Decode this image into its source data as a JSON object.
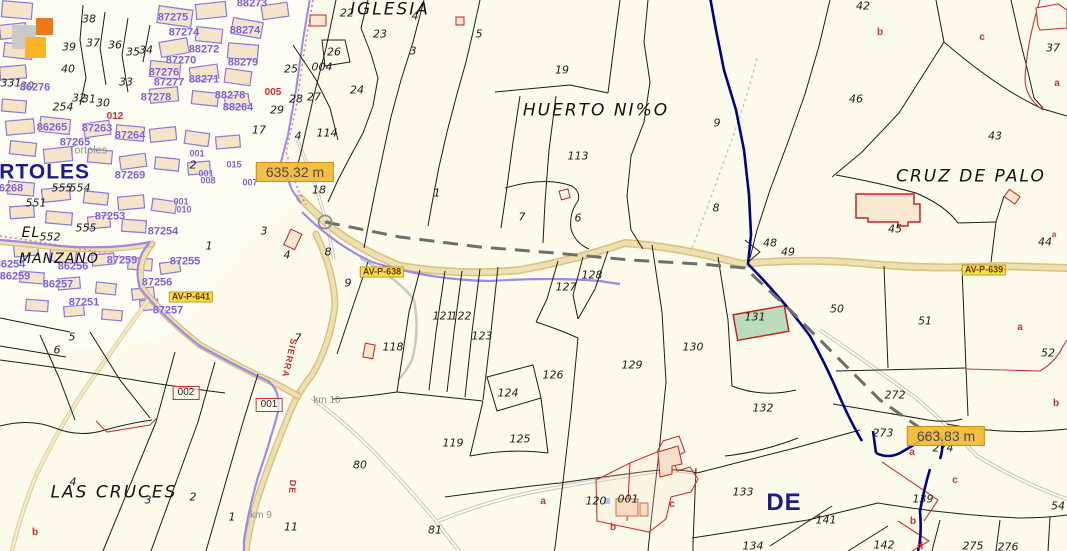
{
  "place_labels": {
    "iglesia": "IGLESIA",
    "huerto": "HUERTO NI%O",
    "cruz_de_palo": "CRUZ DE PALO",
    "el": "EL",
    "manzano": "MANZANO",
    "las_cruces": "LAS CRUCES",
    "town_gray": "Tortoles",
    "town_navy": "ORTOLES",
    "de_navy": "DE"
  },
  "streets": {
    "sierra": "SIERRA",
    "de": "DE"
  },
  "roads": {
    "av638": "AV-P-638",
    "av641": "AV-P-641",
    "av639": "AV-P-639"
  },
  "measurements": {
    "first": "635.32 m",
    "second": "663.83 m"
  },
  "km": {
    "km10": "km 10",
    "km9": "km 9"
  },
  "boxed": {
    "b002": "002",
    "b001": "001"
  },
  "colors": {
    "background": "#FDFCEC",
    "parcel_line": "#1C1C1C",
    "urban_purple": "#8878DD",
    "block_label": "#7B5FD9",
    "boundary_navy": "#00008B",
    "road_fill": "#EFE0B0",
    "road_edge": "#D8C080",
    "road_purple": "#9B8AE8",
    "measure_dash": "#6E6E6E",
    "measure_box": "#F3BA34",
    "road_label_box": "#F2E14C",
    "subparcel_red": "#D03030",
    "building_green": "#BBDDBB",
    "tile_gray": "#C9C9C9",
    "tile_orange": "#F07818",
    "tile_amber": "#FFB428"
  },
  "parcel_numbers": [
    {
      "t": "38",
      "x": 89,
      "y": 19
    },
    {
      "t": "39",
      "x": 69,
      "y": 47
    },
    {
      "t": "37",
      "x": 93,
      "y": 43
    },
    {
      "t": "36",
      "x": 115,
      "y": 45
    },
    {
      "t": "35",
      "x": 133,
      "y": 52
    },
    {
      "t": "34",
      "x": 146,
      "y": 50
    },
    {
      "t": "40",
      "x": 68,
      "y": 69
    },
    {
      "t": "33",
      "x": 126,
      "y": 82
    },
    {
      "t": "32",
      "x": 79,
      "y": 98
    },
    {
      "t": "31",
      "x": 89,
      "y": 99
    },
    {
      "t": "30",
      "x": 103,
      "y": 103
    },
    {
      "t": "254",
      "x": 63,
      "y": 107
    },
    {
      "t": "331",
      "x": 11,
      "y": 83
    },
    {
      "t": "30",
      "x": 27,
      "y": 86
    },
    {
      "t": "25",
      "x": 291,
      "y": 69
    },
    {
      "t": "28",
      "x": 296,
      "y": 99
    },
    {
      "t": "29",
      "x": 277,
      "y": 110
    },
    {
      "t": "27",
      "x": 314,
      "y": 97
    },
    {
      "t": "26",
      "x": 334,
      "y": 52
    },
    {
      "t": "004",
      "x": 322,
      "y": 67
    },
    {
      "t": "24",
      "x": 357,
      "y": 90
    },
    {
      "t": "23",
      "x": 380,
      "y": 34
    },
    {
      "t": "22",
      "x": 347,
      "y": 13
    },
    {
      "t": "114",
      "x": 327,
      "y": 133
    },
    {
      "t": "17",
      "x": 259,
      "y": 130
    },
    {
      "t": "4",
      "x": 298,
      "y": 136
    },
    {
      "t": "4",
      "x": 415,
      "y": 16
    },
    {
      "t": "3",
      "x": 413,
      "y": 51
    },
    {
      "t": "5",
      "x": 479,
      "y": 34
    },
    {
      "t": "2",
      "x": 193,
      "y": 165
    },
    {
      "t": "18",
      "x": 319,
      "y": 190
    },
    {
      "t": "1",
      "x": 209,
      "y": 246
    },
    {
      "t": "3",
      "x": 264,
      "y": 231
    },
    {
      "t": "4",
      "x": 287,
      "y": 255
    },
    {
      "t": "8",
      "x": 328,
      "y": 252
    },
    {
      "t": "19",
      "x": 562,
      "y": 70
    },
    {
      "t": "113",
      "x": 578,
      "y": 156
    },
    {
      "t": "9",
      "x": 717,
      "y": 123
    },
    {
      "t": "1",
      "x": 437,
      "y": 193
    },
    {
      "t": "7",
      "x": 522,
      "y": 217
    },
    {
      "t": "6",
      "x": 578,
      "y": 218
    },
    {
      "t": "8",
      "x": 716,
      "y": 208
    },
    {
      "t": "555",
      "x": 62,
      "y": 188
    },
    {
      "t": "554",
      "x": 80,
      "y": 188
    },
    {
      "t": "551",
      "x": 36,
      "y": 203
    },
    {
      "t": "555",
      "x": 86,
      "y": 228
    },
    {
      "t": "552",
      "x": 50,
      "y": 237
    },
    {
      "t": "48",
      "x": 770,
      "y": 243
    },
    {
      "t": "49",
      "x": 788,
      "y": 252
    },
    {
      "t": "42",
      "x": 863,
      "y": 6
    },
    {
      "t": "46",
      "x": 856,
      "y": 99
    },
    {
      "t": "37",
      "x": 1053,
      "y": 48
    },
    {
      "t": "43",
      "x": 995,
      "y": 136
    },
    {
      "t": "45",
      "x": 895,
      "y": 229
    },
    {
      "t": "44",
      "x": 1045,
      "y": 242
    },
    {
      "t": "50",
      "x": 837,
      "y": 309
    },
    {
      "t": "51",
      "x": 925,
      "y": 321
    },
    {
      "t": "52",
      "x": 1048,
      "y": 353
    },
    {
      "t": "272",
      "x": 895,
      "y": 395
    },
    {
      "t": "273",
      "x": 883,
      "y": 433
    },
    {
      "t": "274",
      "x": 943,
      "y": 448
    },
    {
      "t": "9",
      "x": 348,
      "y": 283
    },
    {
      "t": "7",
      "x": 298,
      "y": 338
    },
    {
      "t": "5",
      "x": 72,
      "y": 337
    },
    {
      "t": "6",
      "x": 57,
      "y": 350
    },
    {
      "t": "118",
      "x": 393,
      "y": 347
    },
    {
      "t": "121",
      "x": 443,
      "y": 316
    },
    {
      "t": "122",
      "x": 461,
      "y": 316
    },
    {
      "t": "123",
      "x": 482,
      "y": 336
    },
    {
      "t": "124",
      "x": 508,
      "y": 393
    },
    {
      "t": "125",
      "x": 520,
      "y": 439
    },
    {
      "t": "119",
      "x": 453,
      "y": 443
    },
    {
      "t": "126",
      "x": 553,
      "y": 375
    },
    {
      "t": "127",
      "x": 566,
      "y": 287
    },
    {
      "t": "128",
      "x": 592,
      "y": 275
    },
    {
      "t": "129",
      "x": 632,
      "y": 365
    },
    {
      "t": "130",
      "x": 693,
      "y": 347
    },
    {
      "t": "131",
      "x": 755,
      "y": 317
    },
    {
      "t": "132",
      "x": 763,
      "y": 408
    },
    {
      "t": "80",
      "x": 360,
      "y": 465
    },
    {
      "t": "81",
      "x": 435,
      "y": 530
    },
    {
      "t": "11",
      "x": 291,
      "y": 527
    },
    {
      "t": "120",
      "x": 596,
      "y": 501
    },
    {
      "t": "001",
      "x": 628,
      "y": 499
    },
    {
      "t": "133",
      "x": 743,
      "y": 492
    },
    {
      "t": "134",
      "x": 753,
      "y": 546
    },
    {
      "t": "141",
      "x": 826,
      "y": 520
    },
    {
      "t": "142",
      "x": 884,
      "y": 545
    },
    {
      "t": "139",
      "x": 923,
      "y": 499
    },
    {
      "t": "54",
      "x": 1058,
      "y": 506
    },
    {
      "t": "275",
      "x": 973,
      "y": 546
    },
    {
      "t": "276",
      "x": 1008,
      "y": 547
    },
    {
      "t": "4",
      "x": 73,
      "y": 482
    },
    {
      "t": "3",
      "x": 148,
      "y": 500
    },
    {
      "t": "2",
      "x": 193,
      "y": 497
    },
    {
      "t": "1",
      "x": 232,
      "y": 517
    }
  ],
  "block_labels": [
    {
      "t": "87275",
      "x": 173,
      "y": 18
    },
    {
      "t": "87274",
      "x": 184,
      "y": 33
    },
    {
      "t": "88274",
      "x": 245,
      "y": 31
    },
    {
      "t": "88273",
      "x": 252,
      "y": 4
    },
    {
      "t": "88272",
      "x": 204,
      "y": 50
    },
    {
      "t": "87270",
      "x": 181,
      "y": 61
    },
    {
      "t": "88279",
      "x": 243,
      "y": 63
    },
    {
      "t": "87276",
      "x": 164,
      "y": 73
    },
    {
      "t": "87277",
      "x": 169,
      "y": 83
    },
    {
      "t": "88271",
      "x": 204,
      "y": 80
    },
    {
      "t": "87278",
      "x": 156,
      "y": 98
    },
    {
      "t": "88278",
      "x": 230,
      "y": 96
    },
    {
      "t": "88264",
      "x": 238,
      "y": 108
    },
    {
      "t": "86276",
      "x": 35,
      "y": 88
    },
    {
      "t": "86265",
      "x": 52,
      "y": 128
    },
    {
      "t": "87263",
      "x": 97,
      "y": 129
    },
    {
      "t": "87264",
      "x": 130,
      "y": 136
    },
    {
      "t": "87265",
      "x": 75,
      "y": 143
    },
    {
      "t": "87269",
      "x": 130,
      "y": 176
    },
    {
      "t": "86268",
      "x": 8,
      "y": 189
    },
    {
      "t": "87253",
      "x": 110,
      "y": 217
    },
    {
      "t": "87254",
      "x": 163,
      "y": 232
    },
    {
      "t": "87259",
      "x": 122,
      "y": 261
    },
    {
      "t": "87255",
      "x": 185,
      "y": 262
    },
    {
      "t": "86256",
      "x": 73,
      "y": 267
    },
    {
      "t": "86254",
      "x": 10,
      "y": 265
    },
    {
      "t": "86259",
      "x": 15,
      "y": 277
    },
    {
      "t": "86257",
      "x": 58,
      "y": 285
    },
    {
      "t": "87256",
      "x": 157,
      "y": 283
    },
    {
      "t": "87251",
      "x": 84,
      "y": 303
    },
    {
      "t": "87257",
      "x": 168,
      "y": 311
    }
  ],
  "urban_small_labels": [
    {
      "t": "001",
      "x": 197,
      "y": 154
    },
    {
      "t": "015",
      "x": 234,
      "y": 165
    },
    {
      "t": "001",
      "x": 206,
      "y": 174
    },
    {
      "t": "008",
      "x": 208,
      "y": 181
    },
    {
      "t": "007",
      "x": 250,
      "y": 183
    },
    {
      "t": "001",
      "x": 181,
      "y": 202
    },
    {
      "t": "010",
      "x": 184,
      "y": 210
    }
  ],
  "red_letters": [
    {
      "t": "b",
      "x": 880,
      "y": 33
    },
    {
      "t": "c",
      "x": 982,
      "y": 38
    },
    {
      "t": "a",
      "x": 1057,
      "y": 84
    },
    {
      "t": "a",
      "x": 1054,
      "y": 235,
      "s": 8
    },
    {
      "t": "a",
      "x": 1020,
      "y": 328
    },
    {
      "t": "b",
      "x": 1056,
      "y": 404
    },
    {
      "t": "a",
      "x": 912,
      "y": 453
    },
    {
      "t": "c",
      "x": 955,
      "y": 481
    },
    {
      "t": "b",
      "x": 913,
      "y": 522
    },
    {
      "t": "d",
      "x": 920,
      "y": 547
    },
    {
      "t": "a",
      "x": 543,
      "y": 502
    },
    {
      "t": "c",
      "x": 672,
      "y": 505
    },
    {
      "t": "b",
      "x": 613,
      "y": 528
    },
    {
      "t": "b",
      "x": 35,
      "y": 533
    },
    {
      "t": "005",
      "x": 273,
      "y": 93
    },
    {
      "t": "012",
      "x": 115,
      "y": 117
    }
  ]
}
